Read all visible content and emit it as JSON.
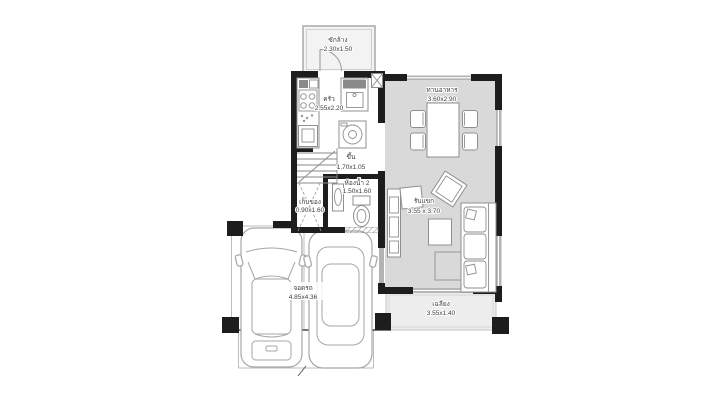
{
  "palette": {
    "wall": "#1d1d1d",
    "floor_gray": "#d9d9d9",
    "terrace_gray": "#ededed",
    "laundry_gray": "#f3f3f3",
    "furniture_stroke": "#8f8f8f",
    "car_stroke": "#a6a6a6",
    "window_gray": "#b3b3b3",
    "label_color": "#3d3d3d"
  },
  "plan": {
    "rooms": {
      "laundry": {
        "name": "ซักล้าง",
        "dims": "2.30x1.50"
      },
      "kitchen": {
        "name": "ครัว",
        "dims": "2.55x2.20"
      },
      "dining": {
        "name": "ทานอาหาร",
        "dims": "3.60x2.90"
      },
      "stairs": {
        "name": "ขึ้น",
        "dims": "1.70x1.05"
      },
      "bathroom": {
        "name": "ห้องน้ำ 2",
        "dims": "1.50x1.60"
      },
      "storage": {
        "name": "เก็บของ",
        "dims": "0.90x1.60"
      },
      "living": {
        "name": "รับแขก",
        "dims": "3.55 x 3.70"
      },
      "terrace": {
        "name": "เฉลียง",
        "dims": "3.55x1.40"
      },
      "garage": {
        "name": "จอดรถ",
        "dims": "4.85x4.36"
      }
    }
  }
}
